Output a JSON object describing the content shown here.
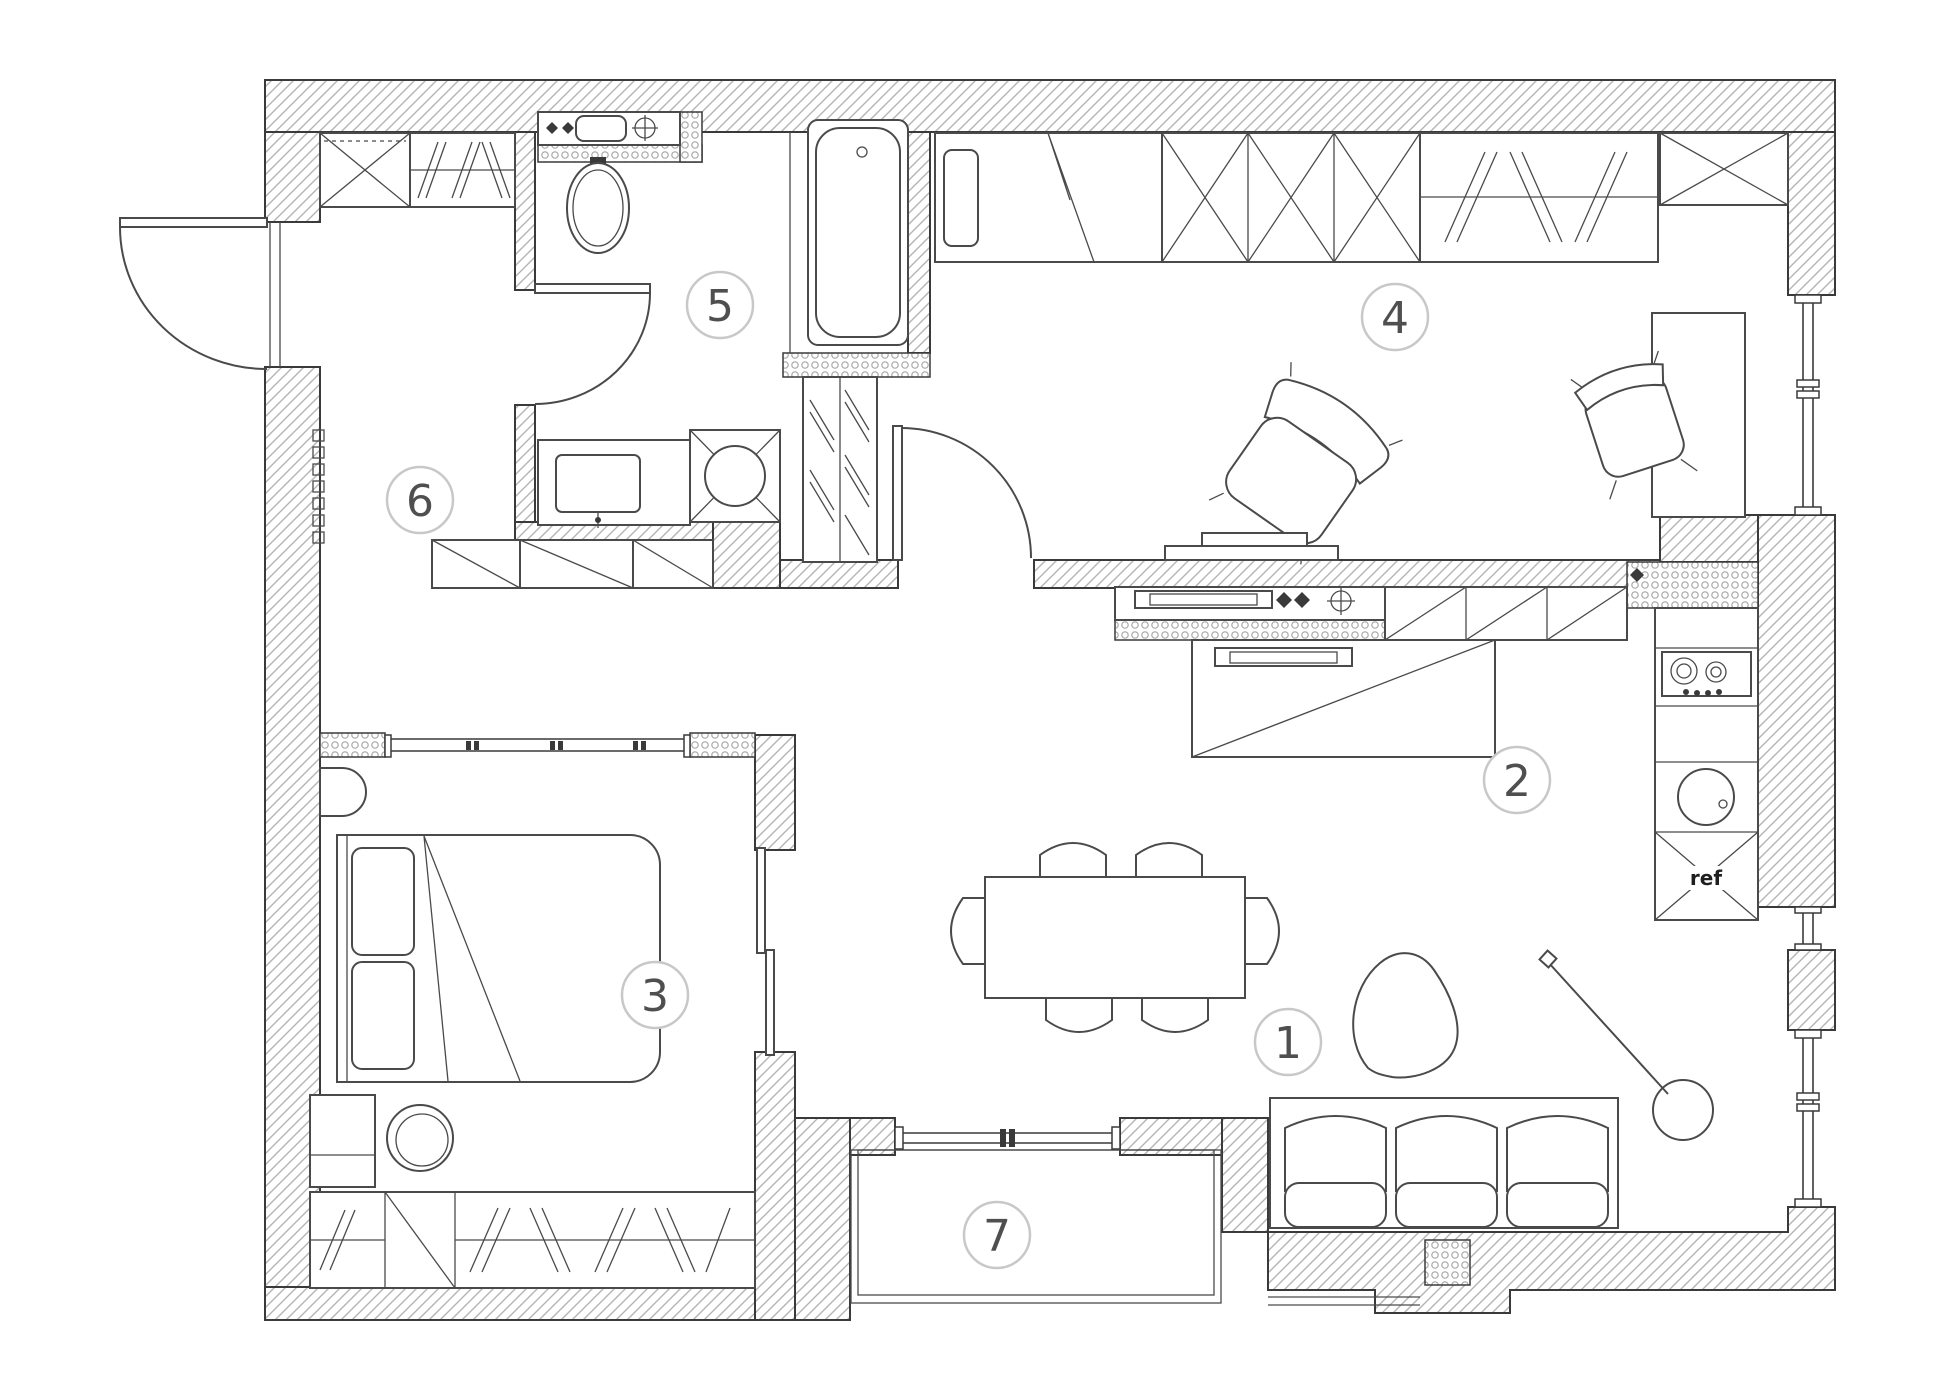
{
  "plan": {
    "colors": {
      "background": "#ffffff",
      "wall_line": "#3a3a3a",
      "wall_hatch": "#b4b4b4",
      "partition_dot": "#a8a8a8",
      "furniture_line": "#4a4a4a",
      "badge_stroke": "#c8c8c8",
      "badge_text": "#4f4f4f",
      "ref_text": "#1f1f1f"
    },
    "rooms": [
      {
        "number": "1"
      },
      {
        "number": "2"
      },
      {
        "number": "3"
      },
      {
        "number": "4"
      },
      {
        "number": "5"
      },
      {
        "number": "6"
      },
      {
        "number": "7"
      }
    ],
    "labels": {
      "refrigerator": "ref"
    }
  }
}
